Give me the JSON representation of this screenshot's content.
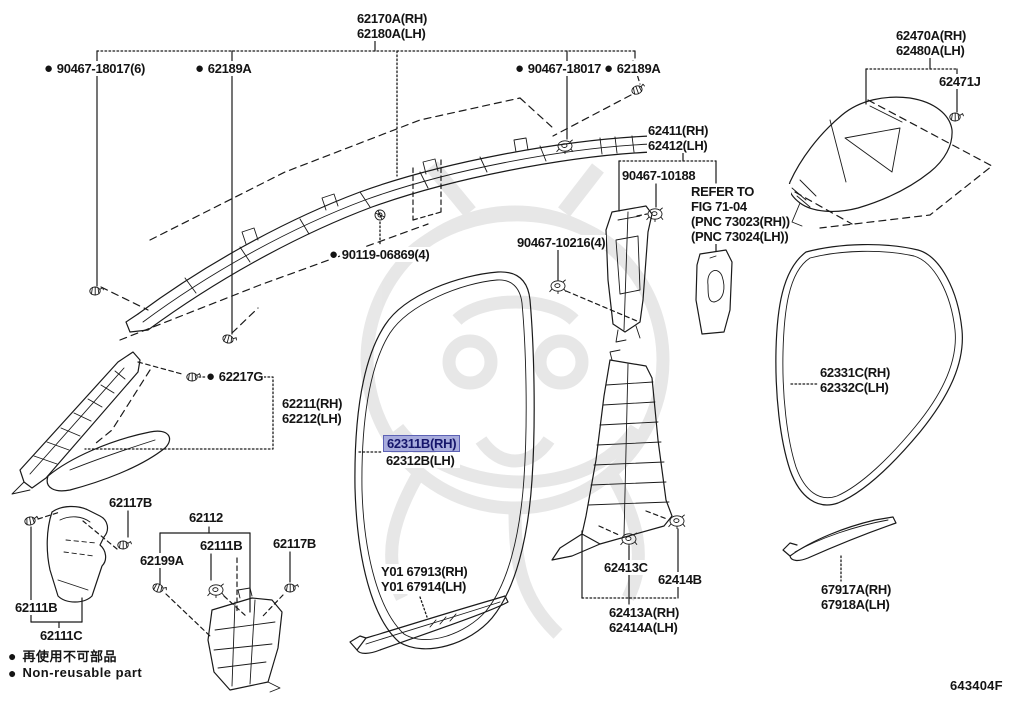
{
  "diagram_code": "643404F",
  "highlight_style": {
    "bg": "#a8acdd",
    "border": "#5c61b5",
    "text": "#16166b"
  },
  "legend": {
    "bullet": "●",
    "jp": "再使用不可部品",
    "en": "Non-reusable part"
  },
  "watermark_color": "#c7c7c7",
  "line_color": "#1a1a1a",
  "labels": [
    {
      "id": "62170a-62180a",
      "x": 356,
      "y": 11,
      "lines": [
        "62170A(RH)",
        "62180A(LH)"
      ]
    },
    {
      "id": "90467-18017-6",
      "x": 44,
      "y": 61,
      "bullet": true,
      "lines": [
        "90467-18017(6)"
      ]
    },
    {
      "id": "62189a-front",
      "x": 195,
      "y": 61,
      "bullet": true,
      "lines": [
        "62189A"
      ]
    },
    {
      "id": "90467-18017",
      "x": 515,
      "y": 61,
      "bullet": true,
      "lines": [
        "90467-18017"
      ]
    },
    {
      "id": "62189a-rear",
      "x": 604,
      "y": 61,
      "bullet": true,
      "lines": [
        "62189A"
      ]
    },
    {
      "id": "62470a-62480a",
      "x": 895,
      "y": 28,
      "lines": [
        "62470A(RH)",
        "62480A(LH)"
      ]
    },
    {
      "id": "62471j",
      "x": 938,
      "y": 74,
      "lines": [
        "62471J"
      ]
    },
    {
      "id": "62411-62412",
      "x": 647,
      "y": 123,
      "lines": [
        "62411(RH)",
        "62412(LH)"
      ]
    },
    {
      "id": "90467-10188",
      "x": 621,
      "y": 168,
      "lines": [
        "90467-10188"
      ]
    },
    {
      "id": "refer-fig",
      "x": 690,
      "y": 184,
      "lines": [
        "REFER TO",
        "FIG 71-04",
        "(PNC 73023(RH))",
        "(PNC 73024(LH))"
      ]
    },
    {
      "id": "90467-10216-4",
      "x": 516,
      "y": 235,
      "lines": [
        "90467-10216(4)"
      ]
    },
    {
      "id": "90119-06869-4",
      "x": 329,
      "y": 247,
      "bullet": true,
      "lines": [
        "90119-06869(4)"
      ]
    },
    {
      "id": "62217g",
      "x": 206,
      "y": 369,
      "bullet": true,
      "lines": [
        "62217G"
      ]
    },
    {
      "id": "62211-62212",
      "x": 281,
      "y": 396,
      "lines": [
        "62211(RH)",
        "62212(LH)"
      ]
    },
    {
      "id": "62311b-62312b",
      "x": 385,
      "y": 437,
      "lines": [
        "62311B(RH)",
        "62312B(LH)"
      ],
      "highlight_line": 0
    },
    {
      "id": "62331c-62332c",
      "x": 819,
      "y": 365,
      "lines": [
        "62331C(RH)",
        "62332C(LH)"
      ]
    },
    {
      "id": "62117b-top",
      "x": 108,
      "y": 495,
      "lines": [
        "62117B"
      ]
    },
    {
      "id": "62112",
      "x": 188,
      "y": 510,
      "lines": [
        "62112"
      ]
    },
    {
      "id": "62111b-mid",
      "x": 199,
      "y": 538,
      "lines": [
        "62111B"
      ]
    },
    {
      "id": "62117b-right",
      "x": 272,
      "y": 536,
      "lines": [
        "62117B"
      ]
    },
    {
      "id": "62199a",
      "x": 139,
      "y": 553,
      "lines": [
        "62199A"
      ]
    },
    {
      "id": "62111b-left",
      "x": 14,
      "y": 600,
      "lines": [
        "62111B"
      ]
    },
    {
      "id": "62111c",
      "x": 39,
      "y": 628,
      "lines": [
        "62111C"
      ]
    },
    {
      "id": "y01-67913-67914",
      "x": 380,
      "y": 564,
      "lines": [
        "Y01 67913(RH)",
        "Y01 67914(LH)"
      ]
    },
    {
      "id": "62413c",
      "x": 603,
      "y": 560,
      "lines": [
        "62413C"
      ]
    },
    {
      "id": "62414b",
      "x": 657,
      "y": 572,
      "lines": [
        "62414B"
      ]
    },
    {
      "id": "62413a-62414a",
      "x": 608,
      "y": 605,
      "lines": [
        "62413A(RH)",
        "62414A(LH)"
      ]
    },
    {
      "id": "67917a-67918a",
      "x": 820,
      "y": 582,
      "lines": [
        "67917A(RH)",
        "67918A(LH)"
      ]
    }
  ]
}
